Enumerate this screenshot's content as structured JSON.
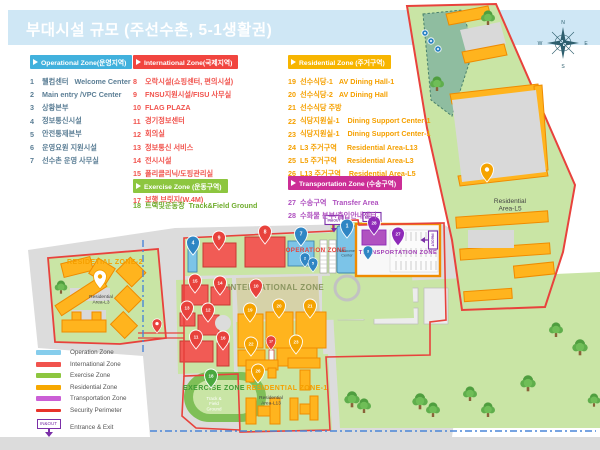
{
  "title": "부대시설 규모 (주선수촌, 5-1생활권)",
  "zones": {
    "operational": {
      "header": "Operational Zone(운영지역)",
      "header_color": "#41b1dd",
      "item_color": "#5b7e95",
      "items": [
        {
          "num": "1",
          "label": "웰컴센터   Welcome Center"
        },
        {
          "num": "2",
          "label": "Main entry /VPC Center"
        },
        {
          "num": "3",
          "label": "상황본부"
        },
        {
          "num": "4",
          "label": "정보통신시설"
        },
        {
          "num": "5",
          "label": "안전통제본부"
        },
        {
          "num": "6",
          "label": "운영요원 지원시설"
        },
        {
          "num": "7",
          "label": "선수촌 운영 사무실"
        }
      ]
    },
    "international": {
      "header": "International Zone(국제지역)",
      "header_color": "#f1453f",
      "item_color": "#f1534d",
      "items": [
        {
          "num": "8",
          "label": "오락시설(쇼핑센터, 편의시설)"
        },
        {
          "num": "9",
          "label": "FNSU지원시설/FISU 사무실"
        },
        {
          "num": "10",
          "label": "FLAG PLAZA"
        },
        {
          "num": "11",
          "label": "경기정보센터"
        },
        {
          "num": "12",
          "label": "회의실"
        },
        {
          "num": "13",
          "label": "정보통신 서비스"
        },
        {
          "num": "14",
          "label": "전시시설"
        },
        {
          "num": "15",
          "label": "폴리클리닉/도핑관리실"
        },
        {
          "num": "16",
          "label": "피트니스"
        },
        {
          "num": "17",
          "label": "보행 브릿지(W.4M)"
        }
      ]
    },
    "residential": {
      "header": "Residential Zone (주거구역)",
      "header_color": "#f7b500",
      "item_color": "#f5a000",
      "items": [
        {
          "num": "19",
          "label": "선수식당-1   AV Dining Hall-1"
        },
        {
          "num": "20",
          "label": "선수식당-2   AV Dining Hall"
        },
        {
          "num": "21",
          "label": "선수식당 주방"
        },
        {
          "num": "22",
          "label": "식당지원실-1    Dining Support Center-1"
        },
        {
          "num": "23",
          "label": "식당지원실-1    Dining Support Center-1"
        },
        {
          "num": "24",
          "label": "L3 주거구역     Residential Area-L13"
        },
        {
          "num": "25",
          "label": "L5 주거구역     Residential Area-L3"
        },
        {
          "num": "26",
          "label": "L13 주거구역    Residential Area-L5"
        }
      ]
    },
    "exercise": {
      "header": "Exercise Zone  (운동구역)",
      "header_color": "#8dc63f",
      "item_color": "#70ad2e",
      "items": [
        {
          "num": "18",
          "label": "트랙및운동장  Track&Field Ground"
        }
      ]
    },
    "transportation": {
      "header": "Transportation Zone (수송구역)",
      "header_color": "#cc2e96",
      "item_color": "#b052c0",
      "items": [
        {
          "num": "27",
          "label": "수송구역   Transfer Area"
        },
        {
          "num": "28",
          "label": "수화물 본부/출입안내센터"
        }
      ]
    }
  },
  "legend": {
    "gate_text": "IN&OUT",
    "items": [
      {
        "label": "Operation Zone",
        "color": "#86cdec",
        "type": "swatch"
      },
      {
        "label": "International Zone",
        "color": "#f1534d",
        "type": "swatch"
      },
      {
        "label": "Exercise Zone",
        "color": "#8dc63f",
        "type": "swatch"
      },
      {
        "label": "Residential Zone",
        "color": "#f7a800",
        "type": "swatch"
      },
      {
        "label": "Transportation Zone",
        "color": "#cb5fd6",
        "type": "swatch"
      },
      {
        "label": "Security Perimeter",
        "color": "#e8332a",
        "type": "line"
      },
      {
        "label": "Entrance & Exit",
        "color": "#7b2fa8",
        "type": "gate"
      }
    ]
  },
  "map": {
    "gate_label": "IN&OUT",
    "compass": {
      "n": "N",
      "e": "E",
      "s": "S",
      "w": "W"
    },
    "zone_labels": [
      {
        "text": "OPERATION ZONE",
        "x": 316,
        "y": 252,
        "color": "#e8423c",
        "size": 6.2
      },
      {
        "text": "INTERNATIONAL ZONE",
        "x": 276,
        "y": 290,
        "color": "#8b9660",
        "size": 8
      },
      {
        "text": "TRANSPORTATION ZONE",
        "x": 398,
        "y": 254,
        "color": "#a03ab4",
        "size": 5.8
      },
      {
        "text": "RESIDETIAL ZONE-2",
        "x": 105,
        "y": 264,
        "color": "#f5a000",
        "size": 7
      },
      {
        "text": "RESIDENTIAL ZONE-1",
        "x": 287,
        "y": 390,
        "color": "#f5a000",
        "size": 7
      },
      {
        "text": "EXERCISE ZONE",
        "x": 214,
        "y": 390,
        "color": "#3f9c35",
        "size": 7
      }
    ],
    "area_labels": [
      {
        "lines": [
          "Residential",
          "Area-L5"
        ],
        "x": 510,
        "y": 203,
        "size": 6.5,
        "color": "#444444"
      },
      {
        "lines": [
          "Residential",
          "Area-L3"
        ],
        "x": 101,
        "y": 298,
        "size": 4.8,
        "color": "#444444"
      },
      {
        "lines": [
          "Residential",
          "Area-L13"
        ],
        "x": 271,
        "y": 399,
        "size": 4.8,
        "color": "#444444"
      },
      {
        "lines": [
          "Track &",
          "Field",
          "Ground"
        ],
        "x": 214,
        "y": 400,
        "size": 4.5,
        "color": "#ffffff"
      },
      {
        "lines": [
          "Welcome",
          "Center"
        ],
        "x": 347,
        "y": 252,
        "size": 3.8,
        "color": "#33515e"
      }
    ],
    "pins": [
      {
        "num": "1",
        "x": 347,
        "y": 238,
        "color": "#2f86c4"
      },
      {
        "num": "7",
        "x": 301,
        "y": 246,
        "color": "#2f86c4"
      },
      {
        "num": "4",
        "x": 193,
        "y": 255,
        "color": "#2f86c4"
      },
      {
        "num": "2",
        "x": 305,
        "y": 267,
        "color": "#2f86c4",
        "small": true
      },
      {
        "num": "5",
        "x": 313,
        "y": 272,
        "color": "#2f86c4",
        "small": true
      },
      {
        "num": "3",
        "x": 368,
        "y": 260,
        "color": "#2f86c4",
        "small": true
      },
      {
        "num": "9",
        "x": 219,
        "y": 250,
        "color": "#e8423c"
      },
      {
        "num": "8",
        "x": 265,
        "y": 244,
        "color": "#e8423c"
      },
      {
        "num": "15",
        "x": 195,
        "y": 293,
        "color": "#e8423c"
      },
      {
        "num": "14",
        "x": 220,
        "y": 295,
        "color": "#e8423c"
      },
      {
        "num": "13",
        "x": 187,
        "y": 320,
        "color": "#e8423c"
      },
      {
        "num": "12",
        "x": 208,
        "y": 322,
        "color": "#e8423c"
      },
      {
        "num": "11",
        "x": 196,
        "y": 349,
        "color": "#e8423c"
      },
      {
        "num": "16",
        "x": 223,
        "y": 350,
        "color": "#e8423c"
      },
      {
        "num": "10",
        "x": 256,
        "y": 298,
        "color": "#e8423c"
      },
      {
        "num": "17",
        "x": 271,
        "y": 350,
        "color": "#e8423c",
        "small": true
      },
      {
        "num": "19",
        "x": 250,
        "y": 322,
        "color": "#f5a300"
      },
      {
        "num": "20",
        "x": 279,
        "y": 318,
        "color": "#f5a300"
      },
      {
        "num": "21",
        "x": 310,
        "y": 318,
        "color": "#f5a300"
      },
      {
        "num": "22",
        "x": 251,
        "y": 356,
        "color": "#f5a300"
      },
      {
        "num": "23",
        "x": 296,
        "y": 354,
        "color": "#f5a300"
      },
      {
        "num": "26",
        "x": 258,
        "y": 383,
        "color": "#f5a300"
      },
      {
        "num": "18",
        "x": 211,
        "y": 388,
        "color": "#4aa83e"
      },
      {
        "num": "27",
        "x": 398,
        "y": 246,
        "color": "#8e2bb8"
      },
      {
        "num": "28",
        "x": 374,
        "y": 235,
        "color": "#8e2bb8"
      },
      {
        "num": "",
        "x": 487,
        "y": 182,
        "color": "#f5a300"
      },
      {
        "num": "",
        "x": 100,
        "y": 289,
        "color": "#ffffff",
        "ring": "#f5a300",
        "dot": "#f5a300"
      },
      {
        "num": "",
        "x": 157,
        "y": 333,
        "color": "#e8423c",
        "small": true
      }
    ],
    "gates": [
      {
        "x": 372,
        "y": 217,
        "r": 0
      },
      {
        "x": 334,
        "y": 220,
        "r": 0
      },
      {
        "x": 433,
        "y": 240,
        "r": 90
      }
    ],
    "trees": [
      [
        488,
        22,
        1
      ],
      [
        437,
        88,
        1
      ],
      [
        61,
        291,
        0.9
      ],
      [
        352,
        404,
        1.1
      ],
      [
        364,
        410,
        1
      ],
      [
        420,
        406,
        1.1
      ],
      [
        433,
        414,
        1
      ],
      [
        470,
        398,
        1
      ],
      [
        528,
        388,
        1.1
      ],
      [
        556,
        334,
        1
      ],
      [
        580,
        352,
        1.1
      ],
      [
        488,
        414,
        1
      ],
      [
        594,
        404,
        0.9
      ]
    ]
  }
}
